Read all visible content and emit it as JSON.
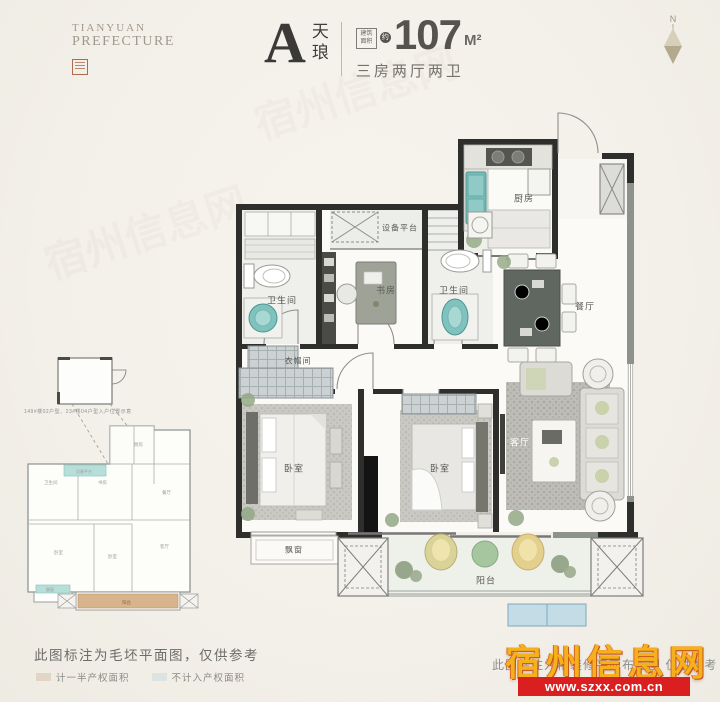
{
  "brand": {
    "line1": "TIANYUAN",
    "line2": "PREFECTURE"
  },
  "header": {
    "unit_letter": "A",
    "unit_name": "天琅",
    "area_box_label": "建筑面积",
    "approx": "约",
    "area_value": "107",
    "area_unit": "M²",
    "spec": "三房两厅两卫"
  },
  "compass": {
    "n": "N"
  },
  "colors": {
    "accent_teal": "#79bdb9",
    "wall_dark": "#2e2e2d",
    "wall_gray": "#8e928d",
    "legend_half": "#e2d5c5",
    "legend_excluded": "#dde2e3",
    "balcony_tan": "#d8b48c",
    "watermark_yellow": "#f5b01c",
    "watermark_red": "#d91f1f"
  },
  "plan": {
    "rooms": {
      "kitchen": {
        "label": "厨房"
      },
      "equipment": {
        "label": "设备平台"
      },
      "bath1": {
        "label": "卫生间"
      },
      "study": {
        "label": "书房"
      },
      "bath2": {
        "label": "卫生间"
      },
      "dining": {
        "label": "餐厅"
      },
      "cloak": {
        "label": "衣帽间"
      },
      "bed1": {
        "label": "卧室"
      },
      "bed2": {
        "label": "卧室"
      },
      "living": {
        "label": "客厅"
      },
      "bay": {
        "label": "飘窗"
      },
      "balcony": {
        "label": "阳台"
      }
    }
  },
  "mini_plan": {
    "note": "149#楼02户型、23#楼04户型入户位置示意",
    "labels": {
      "kitchen": "厨房",
      "study": "书房",
      "bath": "卫生间",
      "dining": "餐厅",
      "living": "客厅",
      "bed": "卧室",
      "balcony": "阳台",
      "equipment": "设备平台",
      "bay": "飘窗"
    }
  },
  "footer": {
    "left_note": "此图标注为毛坯平面图，仅供参考",
    "legend": [
      {
        "label": "计一半产权面积"
      },
      {
        "label": "不计入产权面积"
      }
    ],
    "right_note": "此图标注为精装修平面布置图 仅供参考"
  },
  "watermark": {
    "title": "宿州信息网",
    "url": "www.szxx.com.cn"
  }
}
